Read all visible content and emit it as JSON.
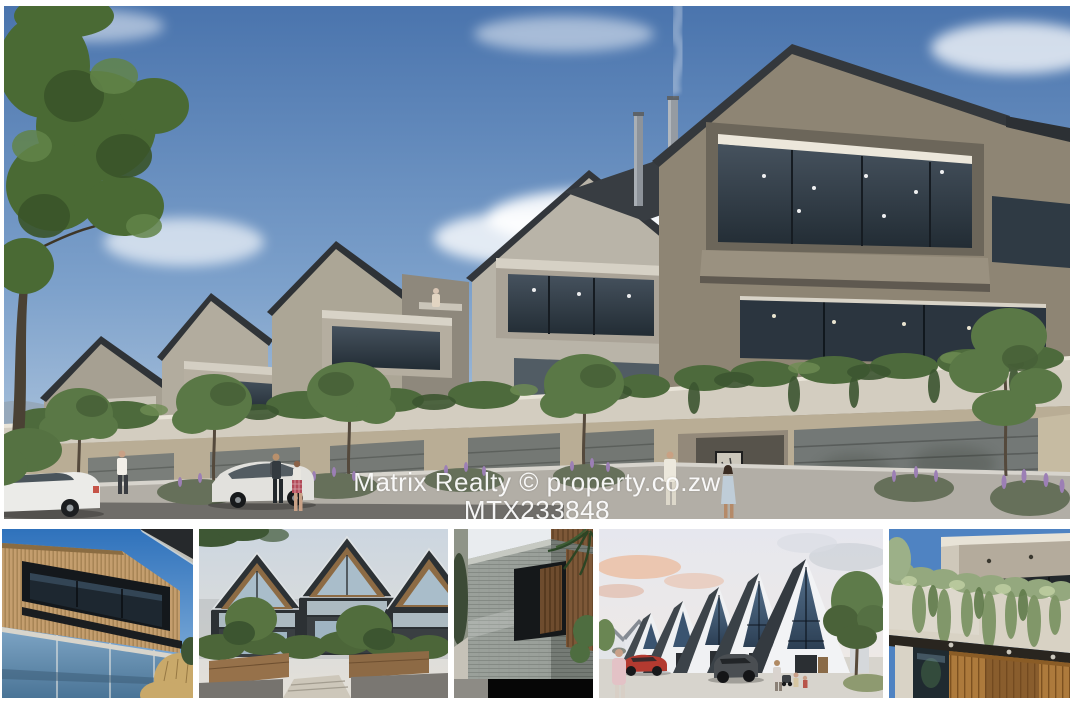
{
  "page_type": "property-listing-photo-collage",
  "watermark": {
    "line1": "Matrix Realty © property.co.zw",
    "line2": "MTX233848",
    "agency": "Matrix Realty",
    "site": "property.co.zw",
    "listing_ref": "MTX233848",
    "text_color": "#ffffff"
  },
  "main_photo": {
    "label": "townhouse-street-elevation-render",
    "house_number": "38"
  },
  "thumbnails": [
    {
      "label": "timber-and-glass-facade-photo"
    },
    {
      "label": "a-frame-townhouses-garden-photo"
    },
    {
      "label": "stone-corner-detail-photo"
    },
    {
      "label": "white-gable-townhouses-street-photo"
    },
    {
      "label": "planted-balcony-timber-entrance-photo"
    }
  ],
  "colors": {
    "background": "#ffffff",
    "sky_top": "#4a74ad",
    "sky_bottom": "#bdd0e3",
    "building_taupe": "#8e8574",
    "roof_dark": "#34383c",
    "concrete_light": "#d3cdc0",
    "foliage_green": "#4d6a3c",
    "street_gray": "#6f6d69",
    "red_car": "#b33a30"
  }
}
